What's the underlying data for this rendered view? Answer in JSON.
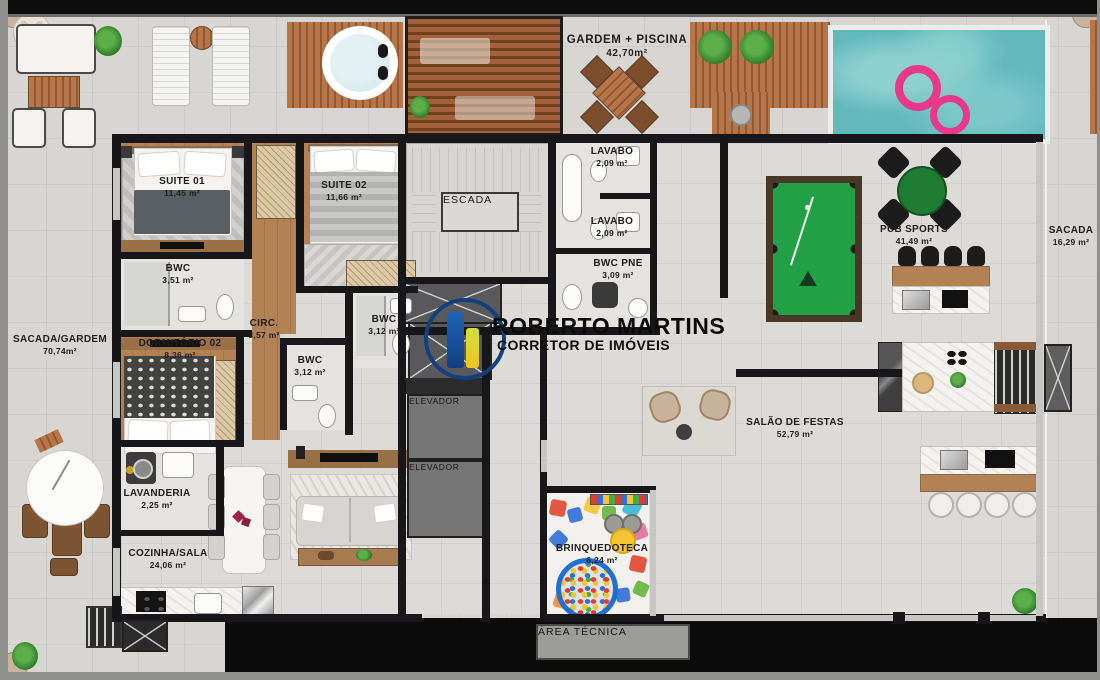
{
  "watermark": {
    "name": "ROBERTO MARTINS",
    "subtitle": "CORRETOR DE IMÓVEIS"
  },
  "rooms": {
    "gardem_piscina": {
      "name": "GARDEM + PISCINA",
      "area": "42,70m²"
    },
    "suite01": {
      "name": "SUITE 01",
      "area": "11,45 m²"
    },
    "suite02": {
      "name": "SUITE 02",
      "area": "11,66 m²"
    },
    "bwc_suite": {
      "name": "BWC",
      "area": "3,51 m²"
    },
    "circ": {
      "name": "CIRC.",
      "area": "3,57 m²"
    },
    "escada": {
      "name": "ESCADA"
    },
    "lavabo_1": {
      "name": "LAVABO",
      "area": "2,09 m²"
    },
    "lavabo_2": {
      "name": "LAVABO",
      "area": "2,09 m²"
    },
    "bwc_pne": {
      "name": "BWC PNE",
      "area": "3,09 m²"
    },
    "bwc_1": {
      "name": "BWC",
      "area": "3,12 m²"
    },
    "bwc_2": {
      "name": "BWC",
      "area": "3,12 m²"
    },
    "sacada_gardem": {
      "name": "SACADA/GARDEM",
      "area": "70,74m²"
    },
    "dormitorio_02": {
      "name": "DORMITÓRIO 02",
      "area": "8,36 m²"
    },
    "lavanderia": {
      "name": "LAVANDERIA",
      "area": "2,25 m²"
    },
    "cozinha_sala": {
      "name": "COZINHA/SALA",
      "area": "24,06 m²"
    },
    "elevador_1": {
      "name": "ELEVADOR"
    },
    "elevador_2": {
      "name": "ELEVADOR"
    },
    "brinquedoteca": {
      "name": "BRINQUEDOTECA",
      "area": "6,24 m²"
    },
    "area_tecnica": {
      "name": "ÁREA TÉCNICA"
    },
    "pub_sports": {
      "name": "PUB SPORTS",
      "area": "41,49 m²"
    },
    "salao_de_festas": {
      "name": "SALÃO DE FESTAS",
      "area": "52,79 m²"
    },
    "sacada": {
      "name": "SACADA",
      "area": "16,29 m²"
    }
  },
  "colors": {
    "wall": "#17171a",
    "floor": "#d7d6d2",
    "wood": "#b28254",
    "deck": "#b5764a",
    "pool": "#63b8bc",
    "float_pink": "#e8388e",
    "felt_green": "#21a046",
    "card_green": "#1d7c31",
    "logo_blue": "#123f7e",
    "logo_yellow": "#f0c41f"
  }
}
